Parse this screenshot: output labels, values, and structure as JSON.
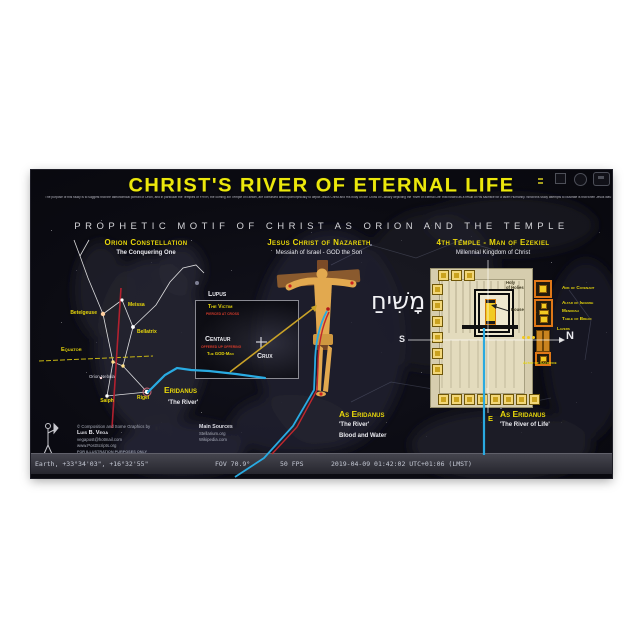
{
  "poster": {
    "title": "CHRIST'S RIVER OF ETERNAL LIFE",
    "intro": "The purpose of this study is to suggest that the astronomical portrait of Orion, and in particular the Temples of YHVH, the coming 4th Temple of Ezekiel, are construed anthropomorphically to depict Jesus Christ and His body on the Cross of Calvary depicting the 'River of Eternal Life' that flowed as a result of His sacrifice for a fallen Humanity. What this study attempts to illustrate is that when Jesus was crucified on the Cross of Calvary, having His side pierced by the Roman spear made 'water and blood' flow out as a 'river'. This can be corroborated astronomically in the constellation of Orion with Eridanus, 'the River', and the Temples that are patterned after the Heavenly prototypes in the approximate same proportions. It is such that for each hand, and where the nails were driven, there is a star, and one single foot, as the 2 feet were nailed as one. The 2nd depiction of how Jesus was so 'pinned' as a 'Victim' and as a 'Sacrifice' is that when the water flowed out of the Temple from the main Temple types of King Solomon and Zerubbabel, the 'River' of Life that will commemorate the 2nd Coming of Jesus Christ will flow from beneath the Holy of Holies out the Eastern Gate to the Kidron Valley. As the Temples faced East, so too was Jesus with the Cross of Calvary facing east as the veil of the Temple was torn in two when Jesus died, opening the way for all to approach the Throne of Grace by the atonement of His blood and water that was poured out for many.",
    "subtitle": "PROPHETIC MOTIF OF CHRIST AS ORION AND THE TEMPLE"
  },
  "orion": {
    "heading": "Orion Constellation",
    "sub": "The Conquering One",
    "stars": {
      "meissa": "Meissa",
      "betelgeuse": "Betelgeuse",
      "bellatrix": "Bellatrix",
      "saiph": "Saiph",
      "rigel": "Rigel"
    },
    "equator": "Equator",
    "nebula": "Orion Nebula",
    "eridanus": "Eridanus",
    "eridanus_sub": "'The River'"
  },
  "inset": {
    "lupus": "Lupus",
    "victim": "The Victim",
    "victim_note": "PIERCED AT CROSS",
    "centaur": "Centaur",
    "centaur_note": "OFFERED UP OFFERING",
    "godman": "The GOD-Man",
    "crux": "Crux"
  },
  "christ": {
    "heading": "Jesus Christ of Nazareth",
    "sub": "Messiah of Israel - GOD the Son",
    "hebrew": "מָשִׁיחַ",
    "as_eridanus": "As Eridanus",
    "river": "'The River'",
    "blood_water": "Blood and Water"
  },
  "temple": {
    "heading": "4th Temple - Man of Ezekiel",
    "sub": "Millennial Kingdom of Christ",
    "holy1": "Holy",
    "holy2": "of Holies",
    "house": "House",
    "ark": "Ark of Covenant",
    "incense": "Altar of Incense",
    "menorah": "Menorah",
    "bread": "Table of Bread",
    "lavers": "Lavers",
    "altar": "Altar of Sacrifice",
    "s": "S",
    "n": "N",
    "e": "E",
    "as_eridanus": "As Eridanus",
    "river": "'The River of Life'"
  },
  "credits": {
    "copyright": "© Composition and Some Graphics by",
    "name": "Luis B. Vega",
    "email": "vegapost@hotmail.com",
    "site": "www.PostScripts.org",
    "notice": "FOR ILLUSTRATION PURPOSES ONLY",
    "sources": "Main Sources",
    "source1": "Stellarium.org",
    "source2": "Wikipedia.com"
  },
  "status": {
    "location": "Earth, +33°34'03\", +16°32'55\"",
    "fov": "FOV 70.9°",
    "fps": "50 FPS",
    "datetime": "2019-04-09 01:42:02 UTC+01:06 (LMST)"
  },
  "colors": {
    "accent_yellow": "#e8d70a",
    "title_yellow": "#ece80c",
    "river_blue": "#29abe2",
    "blood_red": "#c1272d",
    "christ_gold": "#e2a94f"
  }
}
